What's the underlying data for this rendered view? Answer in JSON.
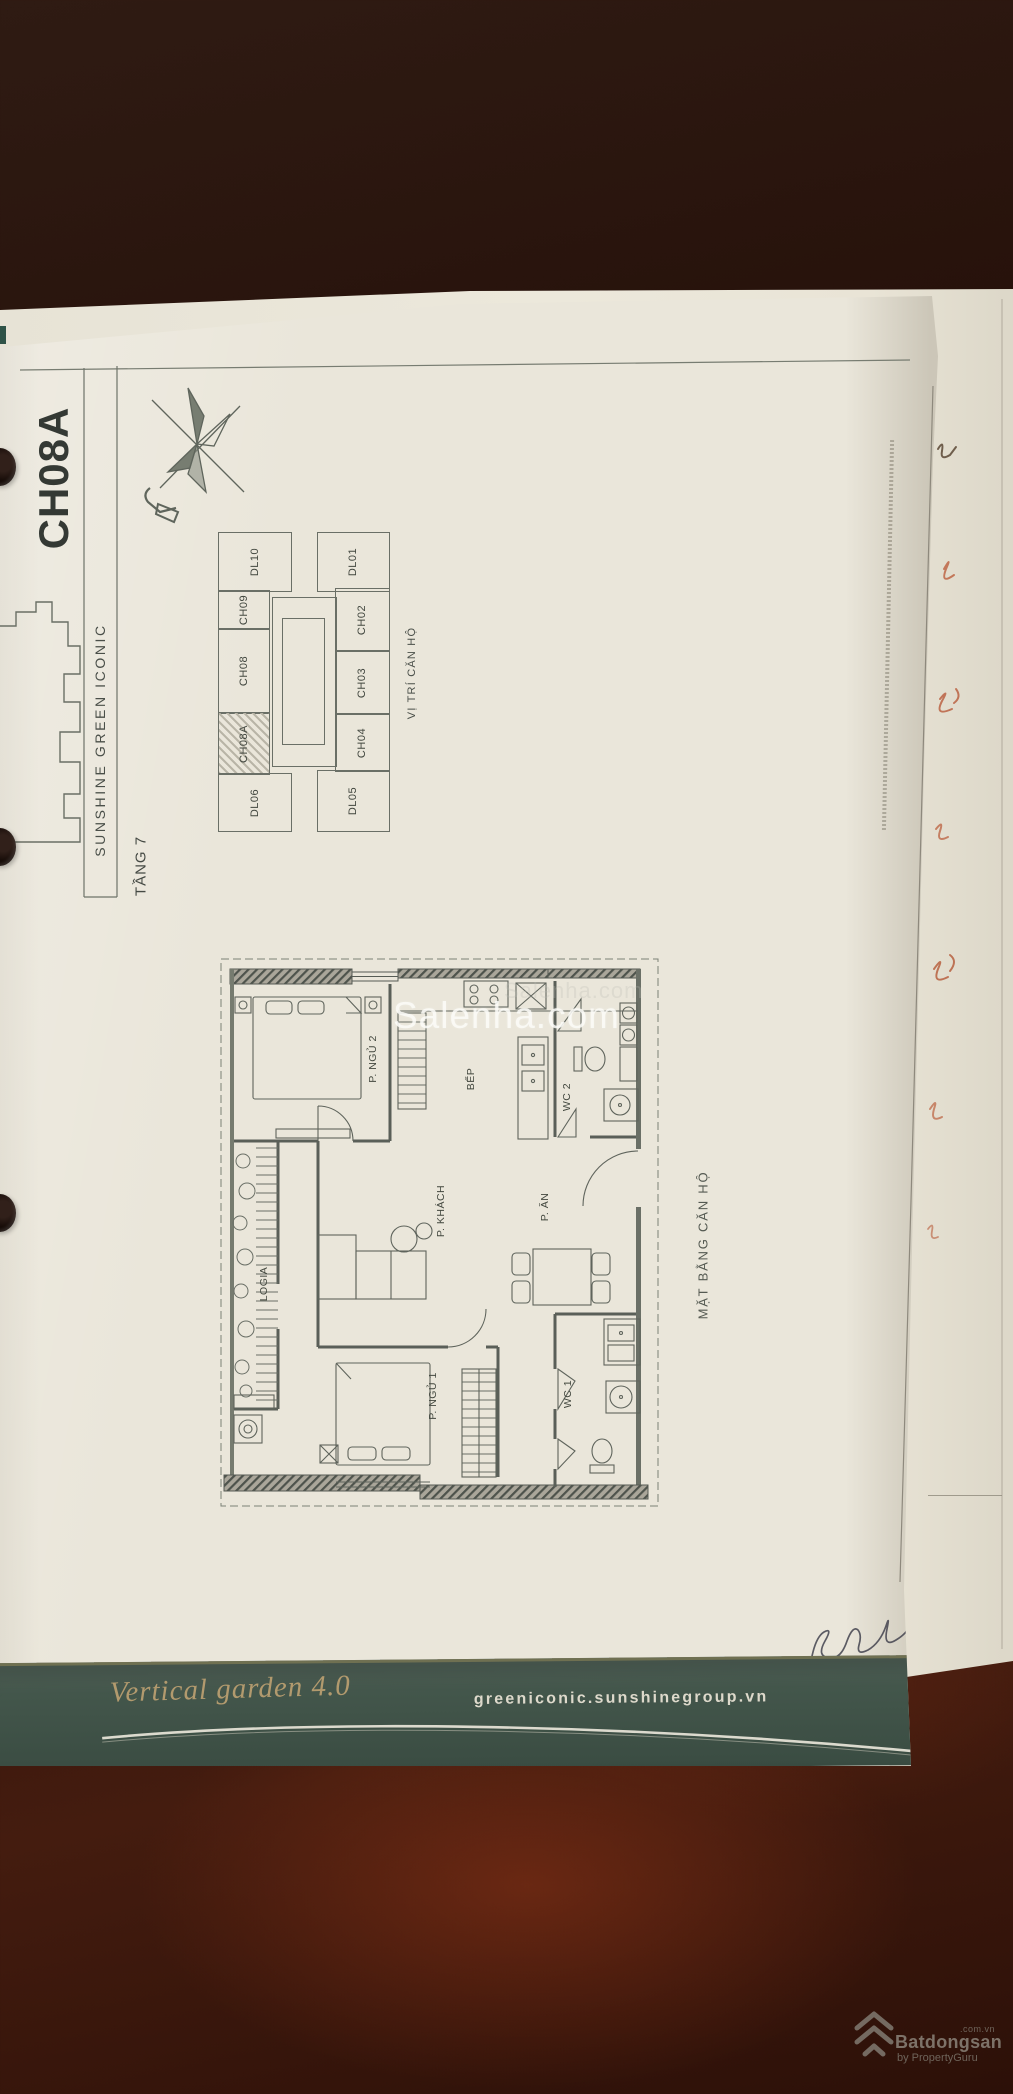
{
  "page": {
    "unit_code": "CH08A",
    "project_name": "SUNSHINE GREEN ICONIC",
    "floor_label": "TẦNG 7",
    "location_diagram": {
      "title": "VỊ TRÍ CĂN HỘ",
      "highlighted_unit": "CH08A",
      "left_column": [
        "DL10",
        "CH09",
        "CH08",
        "CH08A",
        "DL06"
      ],
      "right_column": [
        "DL01",
        "CH02",
        "CH03",
        "CH04",
        "DL05"
      ]
    },
    "floor_plan": {
      "title": "MẶT BẰNG CĂN HỘ",
      "rooms": {
        "bedroom2": "P. NGỦ 2",
        "kitchen": "BẾP",
        "wc2": "WC 2",
        "living": "P. KHÁCH",
        "dining": "P. ĂN",
        "logia": "LOGIA",
        "bedroom1": "P. NGỦ 1",
        "wc1": "WC 1"
      }
    },
    "footer": {
      "slogan": "Vertical garden 4.0",
      "website": "greeniconic.sunshinegroup.vn"
    }
  },
  "watermark": {
    "text": "Salenha.com"
  },
  "branding": {
    "name": "Batdongsan",
    "domain": ".com.vn",
    "byline": "by PropertyGuru"
  },
  "colors": {
    "wood_dark": "#2a130c",
    "wood_red_sheen": "#8c3718",
    "paper": "#eae6da",
    "band_green": "#43564b",
    "script_gold": "#b29a6e",
    "drawing_ink": "#565b54",
    "watermark_white": "#fcfcf8"
  }
}
